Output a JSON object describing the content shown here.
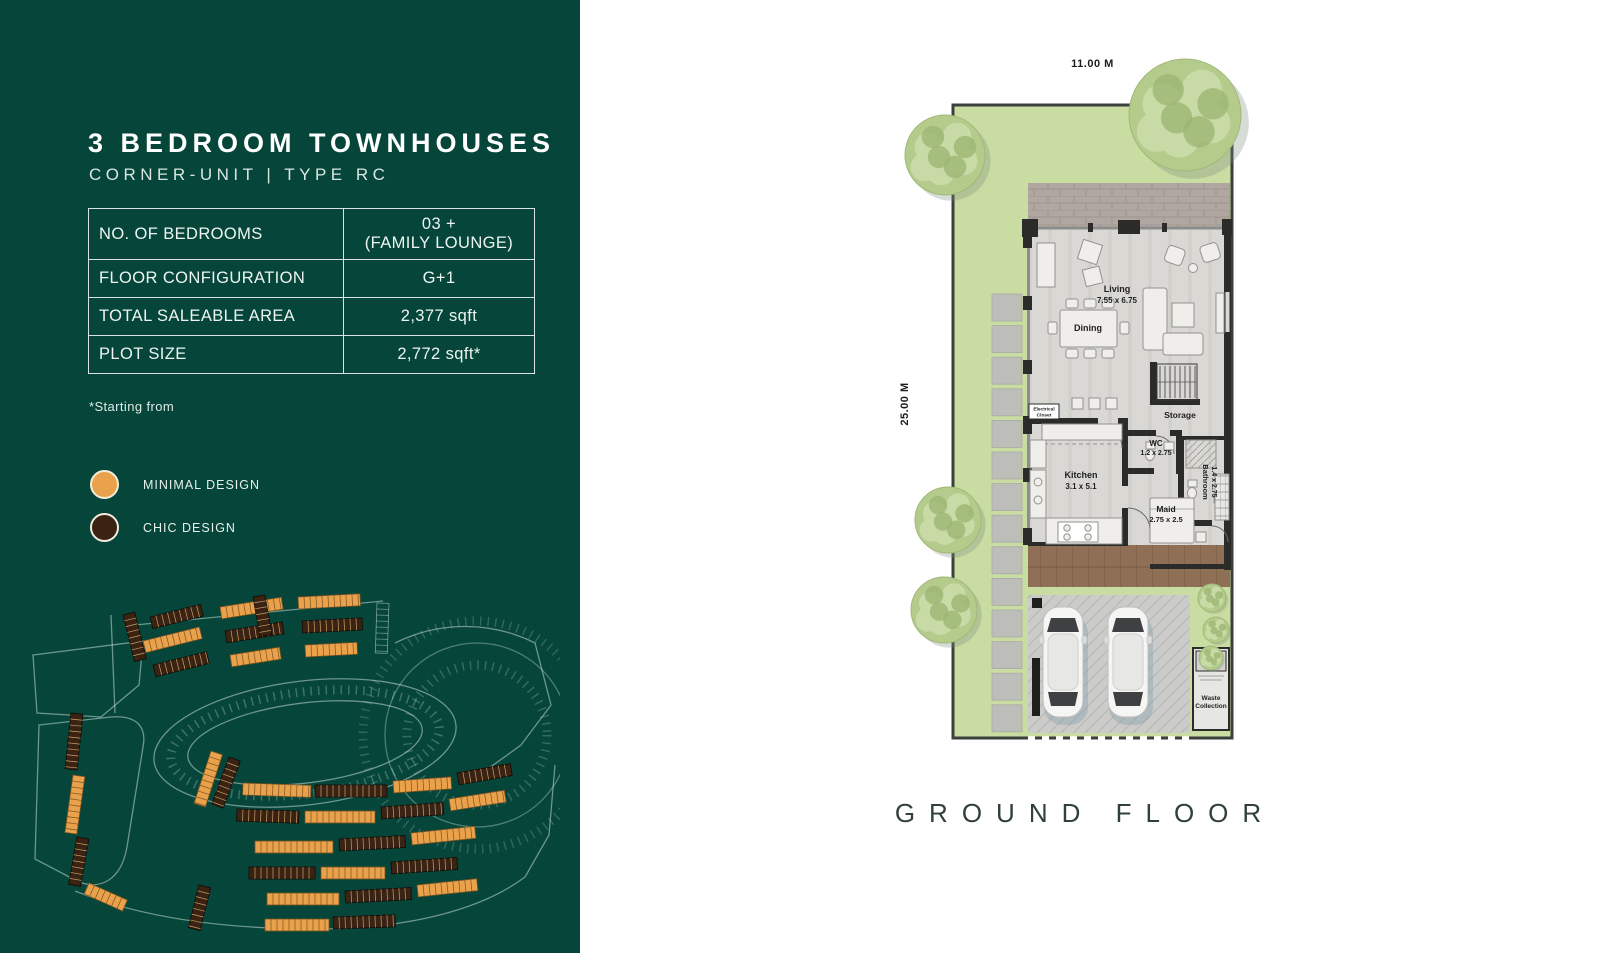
{
  "colors": {
    "panel_bg": "#05453A",
    "minimal_orange": "#E9A24B",
    "chic_brown": "#3A2313",
    "garden_green": "#C9DCA2",
    "floor_gray": "#D9D8D4",
    "wall_dark": "#2B2B29",
    "caption_text": "#30403B"
  },
  "panel": {
    "title": "3 BEDROOM TOWNHOUSES",
    "subtitle": "CORNER-UNIT | TYPE RC",
    "table": {
      "rows": [
        {
          "label": "NO. OF BEDROOMS",
          "value": "03 +\n(FAMILY LOUNGE)"
        },
        {
          "label": "FLOOR CONFIGURATION",
          "value": "G+1"
        },
        {
          "label": "TOTAL SALEABLE AREA",
          "value": "2,377 sqft"
        },
        {
          "label": "PLOT SIZE",
          "value": "2,772 sqft*"
        }
      ]
    },
    "footnote": "*Starting from",
    "legend": [
      {
        "label": "MINIMAL DESIGN",
        "color": "#E9A24B"
      },
      {
        "label": "CHIC DESIGN",
        "color": "#3A2313"
      }
    ]
  },
  "floorplan": {
    "top_dimension": "11.00 M",
    "left_dimension": "25.00 M",
    "caption": "GROUND FLOOR",
    "labels": {
      "living_name": "Living",
      "living_dims": "7.55 x 6.75",
      "dining_name": "Dining",
      "kitchen_name": "Kitchen",
      "kitchen_dims": "3.1 x 5.1",
      "electrical_line1": "Electrical",
      "electrical_line2": "Closet",
      "storage_name": "Storage",
      "wc_name": "WC",
      "wc_dims": "1.2 x 2.75",
      "bathroom_name": "Bathroom",
      "bathroom_dims": "1.4 x 2.75",
      "maid_name": "Maid",
      "maid_dims": "2.75 x 2.5",
      "waste_line1": "Waste",
      "waste_line2": "Collection"
    }
  }
}
